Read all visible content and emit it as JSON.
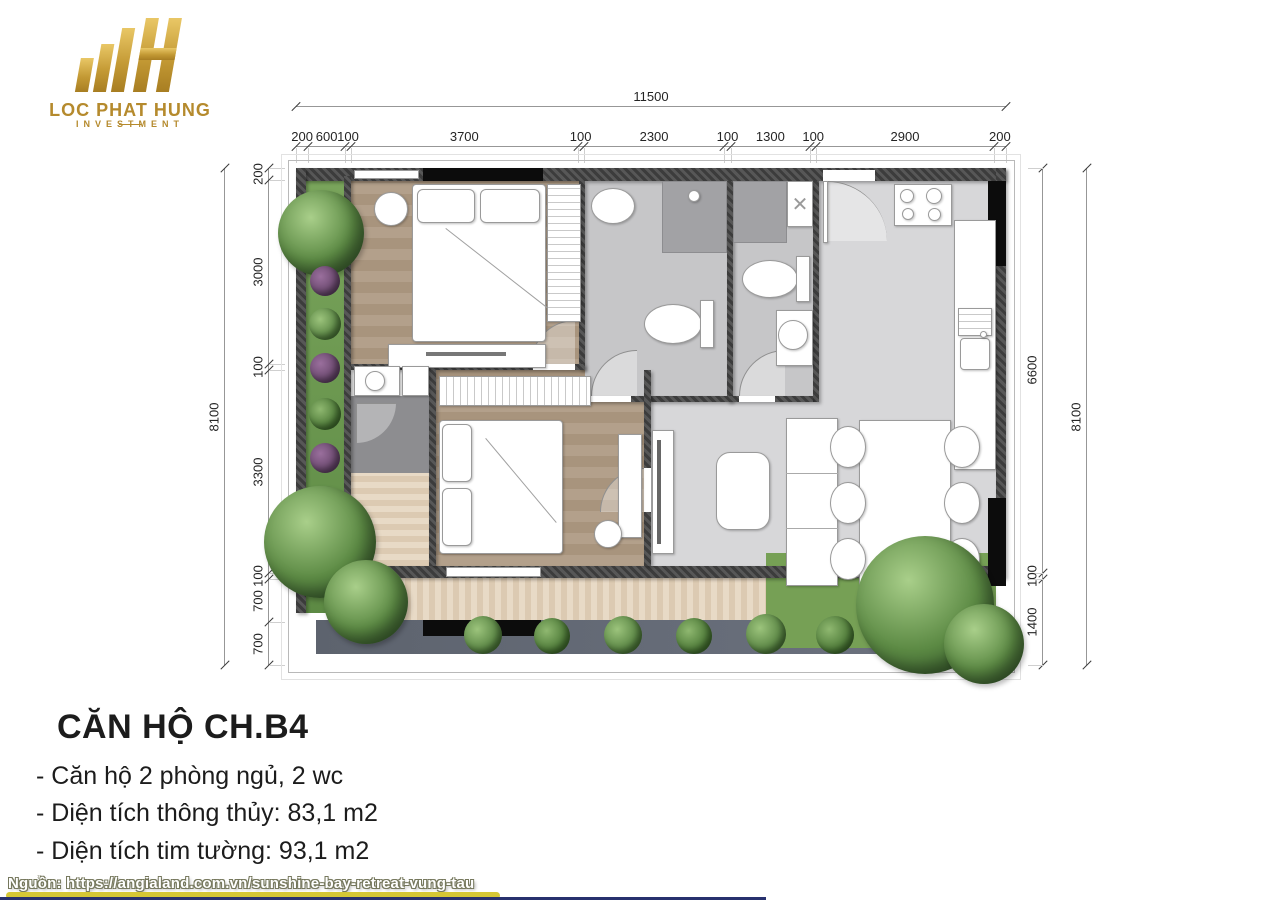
{
  "logo": {
    "name": "LOC PHAT HUNG",
    "sub": "INVESTMENT"
  },
  "dimensions": {
    "top_total": {
      "segments": [
        11500
      ]
    },
    "top_segments": {
      "segments": [
        200,
        600,
        100,
        3700,
        100,
        2300,
        100,
        1300,
        100,
        2900,
        200
      ]
    },
    "left_total": {
      "segments": [
        8100
      ]
    },
    "left_segments": {
      "segments": [
        200,
        3000,
        100,
        3300,
        100,
        700,
        700
      ]
    },
    "right_total": {
      "segments": [
        8100
      ]
    },
    "right_segments": {
      "segments": [
        6600,
        100,
        1400
      ]
    }
  },
  "info": {
    "title": "CĂN HỘ CH.B4",
    "lines": [
      "- Căn hộ 2 phòng ngủ, 2 wc",
      "- Diện tích thông thủy: 83,1 m2",
      "- Diện tích tim tường: 93,1 m2"
    ]
  },
  "source": {
    "text": "Nguồn: https://angialand.com.vn/sunshine-bay-retreat-vung-tau"
  },
  "colors": {
    "gold": "#b58a2d",
    "yellow_bar": "#d5c735",
    "navy_bar": "#28316e",
    "wall": "#454545",
    "wood": "#b19e89",
    "deck": "#e3d4bf",
    "living_gray": "#d7d7d9",
    "bath_gray": "#c6c6c8",
    "plant_green": "#5d8a44"
  }
}
